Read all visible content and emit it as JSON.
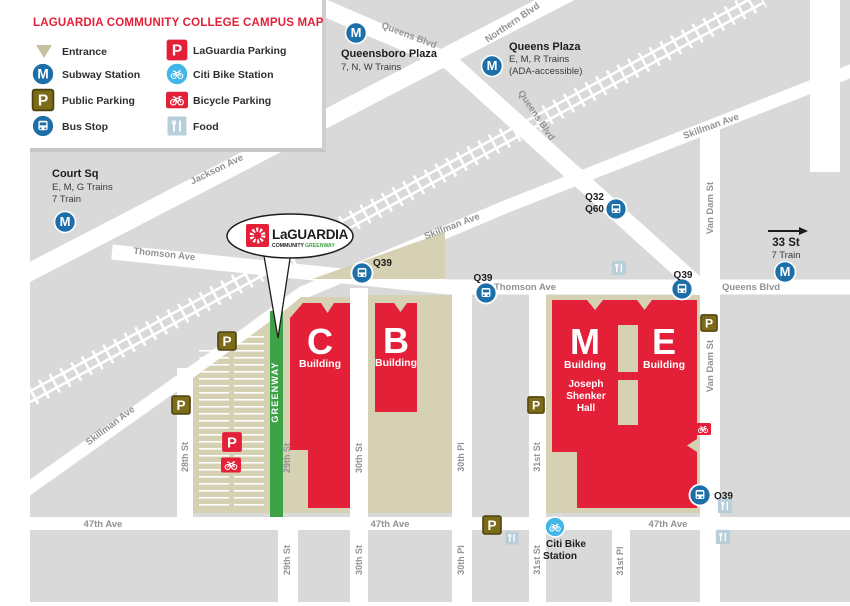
{
  "title": "LAGUARDIA COMMUNITY COLLEGE CAMPUS MAP",
  "legend": {
    "entrance": "Entrance",
    "subway": "Subway Station",
    "public_parking": "Public Parking",
    "bus_stop": "Bus Stop",
    "laguardia_parking": "LaGuardia Parking",
    "citi_bike": "Citi Bike Station",
    "bicycle_parking": "Bicycle Parking",
    "food": "Food"
  },
  "stations": {
    "queensboro": {
      "name": "Queensboro Plaza",
      "lines": "7, N, W Trains"
    },
    "queens_plaza": {
      "name": "Queens Plaza",
      "lines": "E, M, R Trains",
      "ada": "(ADA-accessible)"
    },
    "court_sq": {
      "name": "Court Sq",
      "lines": "E, M, G Trains",
      "lines2": "7 Train"
    },
    "st33": {
      "name": "33 St",
      "lines": "7 Train"
    }
  },
  "bus": {
    "q39": "Q39",
    "q32": "Q32",
    "q60": "Q60"
  },
  "streets": {
    "queens_blvd": "Queens Blvd",
    "northern_blvd": "Northern Blvd",
    "jackson_ave": "Jackson Ave",
    "thomson_ave": "Thomson Ave",
    "skillman_ave": "Skillman Ave",
    "van_dam_st": "Van Dam St",
    "st28": "28th St",
    "st29": "29th St",
    "st30": "30th St",
    "pl30": "30th Pl",
    "st31": "31st St",
    "pl31": "31st Pl",
    "ave47": "47th Ave"
  },
  "buildings": {
    "c": {
      "letter": "C",
      "label": "Building"
    },
    "b": {
      "letter": "B",
      "label": "Building"
    },
    "m": {
      "letter": "M",
      "label": "Building",
      "hall1": "Joseph",
      "hall2": "Shenker",
      "hall3": "Hall"
    },
    "e": {
      "letter": "E",
      "label": "Building"
    }
  },
  "greenway_label": "GREENWAY",
  "citibike_station": {
    "line1": "Citi Bike",
    "line2": "Station"
  },
  "logo": {
    "main": "LaGUARDIA",
    "community": "COMMUNITY",
    "greenway": "GREENWAY"
  },
  "icon_letters": {
    "parking": "P",
    "subway": "M"
  },
  "colors": {
    "brand_red": "#e41f38",
    "campus_tan": "#d5d1b2",
    "block_gray": "#d9d9d9",
    "greenway_green": "#3da145",
    "transit_blue": "#1c6fa9",
    "citibike_blue": "#41b6e8",
    "food_blue": "#b8cfd9",
    "public_parking_olive": "#7c6c1a",
    "entrance_tan": "#c6c09f"
  }
}
